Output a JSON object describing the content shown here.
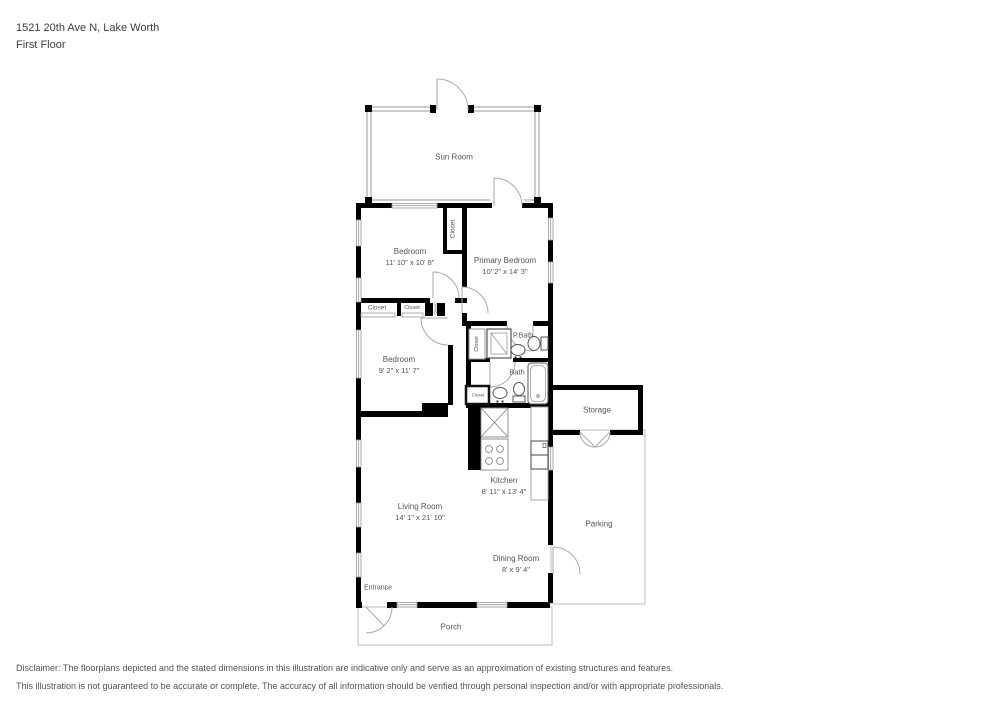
{
  "header": {
    "address": "1521 20th Ave N, Lake Worth",
    "floor_label": "First Floor"
  },
  "rooms": {
    "sun_room": {
      "name": "Sun Room"
    },
    "bedroom_top": {
      "name": "Bedroom",
      "dims": "11' 10\" x 10' 8\""
    },
    "primary_bedroom": {
      "name": "Primary Bedroom",
      "dims": "10' 2\" x 14' 3\""
    },
    "bedroom_left": {
      "name": "Bedroom",
      "dims": "9' 2\" x 11' 7\""
    },
    "primary_bath": {
      "name": "P.Bath"
    },
    "bath": {
      "name": "Bath"
    },
    "storage": {
      "name": "Storage"
    },
    "kitchen": {
      "name": "Kitchen",
      "dims": "8' 11\" x 13' 4\""
    },
    "living_room": {
      "name": "Living Room",
      "dims": "14' 1\" x 21' 10\""
    },
    "dining_room": {
      "name": "Dining Room",
      "dims": "8' x 9' 4\""
    },
    "parking": {
      "name": "Parking"
    },
    "porch": {
      "name": "Porch"
    },
    "entrance": {
      "name": "Entrance"
    }
  },
  "closets": {
    "c1": "Closet",
    "c2": "Closet",
    "c3": "Closet",
    "c4": "Closet",
    "c5": "Closet",
    "c6": "Closet"
  },
  "disclaimer": {
    "line1": "Disclaimer: The floorplans depicted and the stated dimensions in this illustration are indicative only and serve as an approximation of existing structures and features.",
    "line2": "This illustration is not guaranteed to be accurate or complete. The accuracy of all information should be verified through personal inspection and/or with appropriate professionals."
  },
  "colors": {
    "wall": "#000000",
    "light_outline": "#b9b9b9",
    "text": "#555555"
  }
}
